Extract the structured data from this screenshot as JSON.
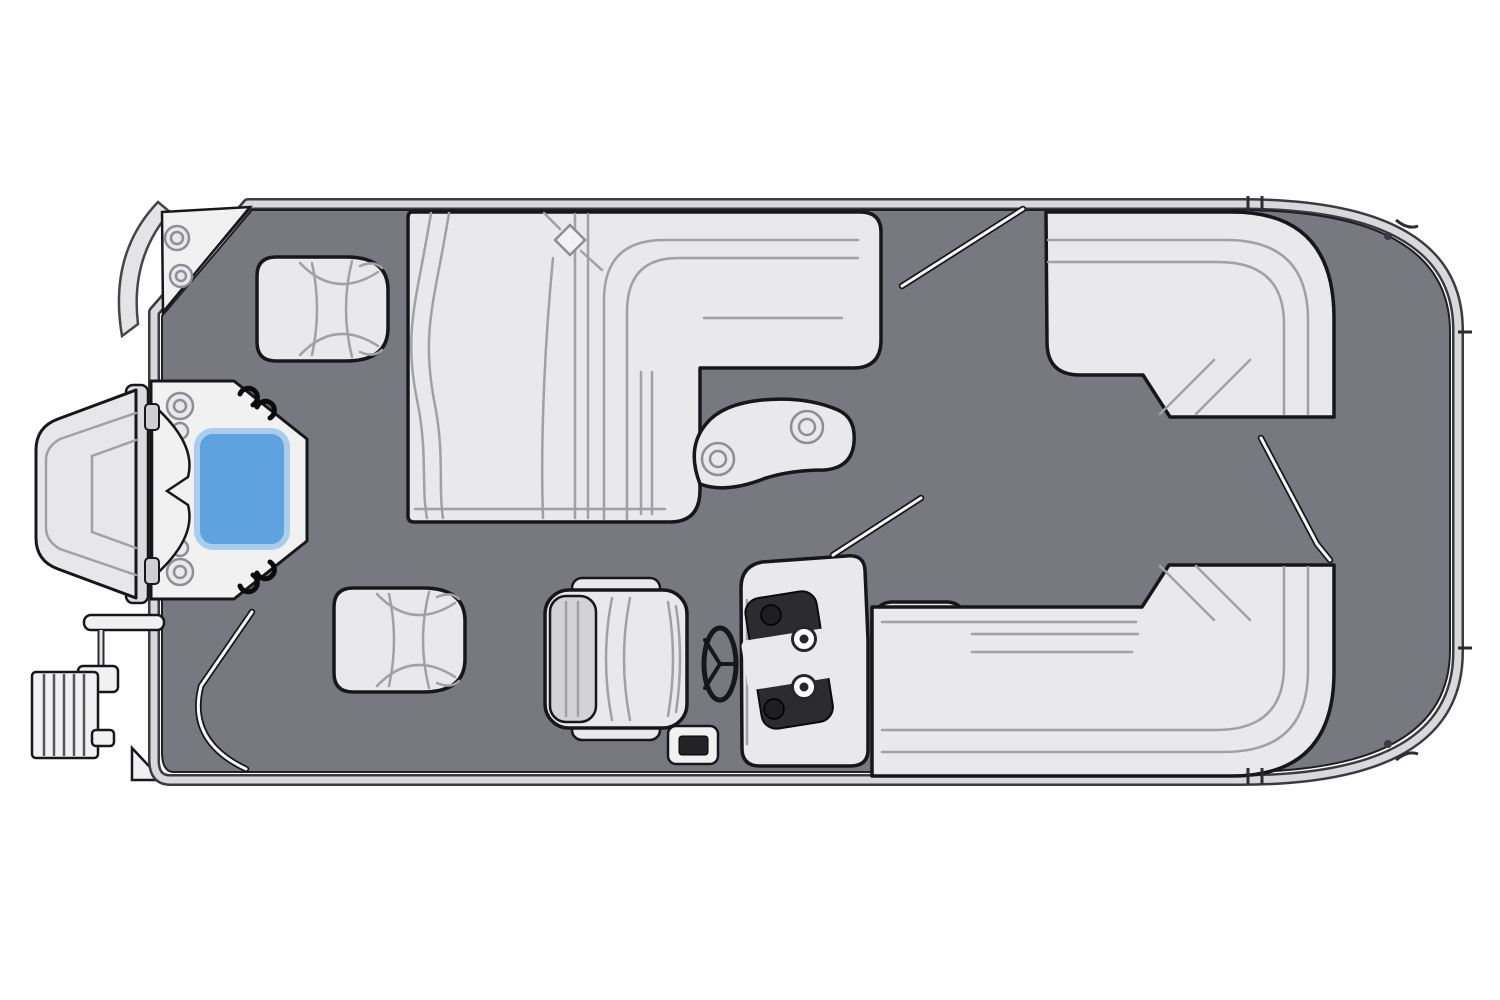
{
  "canvas": {
    "width": 1500,
    "height": 1000
  },
  "colors": {
    "background": "#ffffff",
    "deck": "#787880",
    "deckEdge": "#1f1f24",
    "outline": "#17171b",
    "cushion": "#e9e9eb",
    "cushionShade": "#d3d3d7",
    "seam": "#a0a0a7",
    "railLight": "#d9d9db",
    "railDark": "#3a3a40",
    "panelDark": "#2b2b30",
    "tableBlue": "#5ea3e0",
    "tableBlueHalo": "#aacdec",
    "platform": "#f1f1f2",
    "hardware": "#8e8e95",
    "gateLine": "#fafafa"
  },
  "diagram": {
    "type": "pontoon-boat-floor-plan",
    "view": "top-down",
    "components": [
      {
        "name": "perimeter-rail",
        "desc": "fence rail outlining the hull, rounded at right end"
      },
      {
        "name": "deck-carpet",
        "desc": "gray interior deck floor"
      },
      {
        "name": "outboard-motor",
        "desc": "motor drawn outside the left end"
      },
      {
        "name": "boarding-ladder",
        "desc": "ladder with rungs, lower-left exterior"
      },
      {
        "name": "stern-corner-platform",
        "desc": "corner step with two round fittings, upper-left"
      },
      {
        "name": "stern-gate-platform",
        "desc": "angled platform with hinges and latches, left center"
      },
      {
        "name": "blue-table",
        "desc": "blue rounded rectangle on the stern platform",
        "color": "#5ea3e0"
      },
      {
        "name": "stern-seat-port",
        "desc": "square seat, upper-left"
      },
      {
        "name": "stern-seat-starboard",
        "desc": "square seat, lower-left"
      },
      {
        "name": "port-lounge",
        "desc": "L-shaped chaise lounge along the top"
      },
      {
        "name": "cocktail-table",
        "desc": "kidney-shaped table with two cup holders"
      },
      {
        "name": "captains-chair",
        "desc": "helm seat facing the console"
      },
      {
        "name": "steering-wheel",
        "desc": "wheel between seat and console"
      },
      {
        "name": "helm-console",
        "desc": "console with dark gauge panel and four gauges"
      },
      {
        "name": "step-box",
        "desc": "small box with dark inset beside the console"
      },
      {
        "name": "starboard-bench",
        "desc": "straight bench aft of the helm"
      },
      {
        "name": "bow-lounge-port",
        "desc": "wraparound corner lounge, upper-right"
      },
      {
        "name": "bow-lounge-starboard",
        "desc": "wraparound corner lounge, lower-right"
      },
      {
        "name": "gate-openings",
        "desc": "four thin gate rail lines"
      },
      {
        "name": "transom-bracket",
        "desc": "scalloped bracket left of the platform"
      }
    ]
  }
}
